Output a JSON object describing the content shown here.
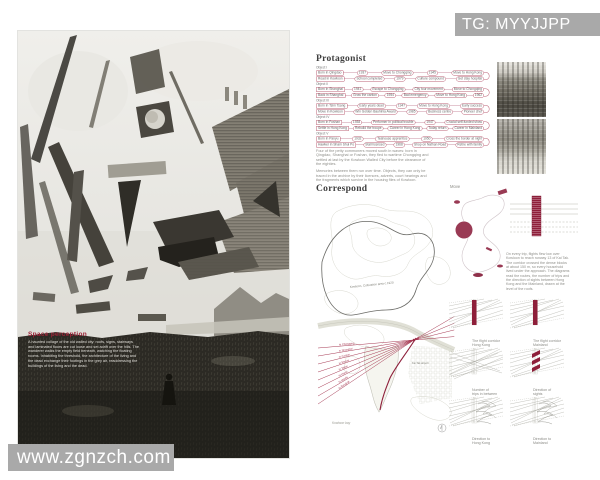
{
  "watermark_top": {
    "text": "TG: MYYJJPP"
  },
  "watermark_bottom": {
    "text": "www.zgnzch.com"
  },
  "poster": {
    "heading": "Space perception",
    "body": "A haunted collage of the old walled city: roofs, signs, stairways and laminated floors are cut loose and set adrift over the hills. The wanderer walks the empty field beneath, watching the floating rooms. Inhabiting the threshold, the architecture of the living and the dead exchange their footings in the grey air, readdressing the buildings of the living and the dead."
  },
  "protagonist": {
    "title": "Protagonist",
    "groups": [
      {
        "label": "Object I",
        "rows": [
          [
            "Born in Qingdao",
            "1937",
            "Move to Chongqing",
            "1945",
            "Move to Hong Kong"
          ],
          [
            "Road in Kowloon",
            "School completed",
            "1979",
            "Culture compound",
            "Get stay hospital"
          ]
        ]
      },
      {
        "label": "Object II",
        "rows": [
          [
            "Born in Shanghai",
            "1941",
            "Escape to Chongqing",
            "City tour movement",
            "Move to Chongqing"
          ],
          [
            "Back in Shanghai",
            "Grow the canton",
            "1954",
            "Bad emergency",
            "Move to Hong Kong",
            "1962"
          ]
        ]
      },
      {
        "label": "Object III",
        "rows": [
          [
            "Born in Tsim Tsang",
            "Early years dead",
            "1947",
            "Move to Hong Kong",
            "Early success"
          ],
          [
            "Move in Kowloon",
            "Win Golden Bauhinia Award",
            "1985",
            "Business centre",
            "Pioneer chef"
          ]
        ]
      },
      {
        "label": "Object IV",
        "rows": [
          [
            "Born in Foshan",
            "1938",
            "Performer in political trouble",
            "1947",
            "Crucial self-funded show"
          ],
          [
            "Settle in Hong Kong",
            "Rebuild the troupe",
            "Career in Hong Kong",
            "Today return",
            "Career in Mainland"
          ]
        ]
      },
      {
        "label": "Object V",
        "rows": [
          [
            "Born in Panyu",
            "1932",
            "Teahouse apprentice",
            "1950",
            "Cross the border at night"
          ],
          [
            "Hawker in Sham Shui Po",
            "Stall licensed",
            "1968",
            "Shop on Nathan Road",
            "Retire with family"
          ]
        ]
      }
    ],
    "notes": [
      "Four of the petty commoners moved south in waves: born in Qingdao, Shanghai or Foshan, they fled to wartime Chongqing and settled at last by the Kowloon Walled City before the clearance of the eighties.",
      "Memories between them run over time. Objects, they can only be traced in the archive by their licences, adverts, court hearings and the fragments which survive in the housing files of Kowloon."
    ]
  },
  "correspond": {
    "title": "Correspond",
    "move_label": "Move",
    "map": {
      "area_label": "Kowloon, Cultivation area c.1920",
      "airport_label": "Kai Tak airport",
      "bay_label": "Kowloon bay"
    },
    "routes": [
      "to Chongqing",
      "to Shanghai",
      "to Canton",
      "to Macau",
      "to Taipei",
      "to Hanoi",
      "to Manila",
      "to Bangkok"
    ],
    "note": "On every trip, flights flew low over Kowloon to reach runway 13 of Kai Tak. The corridor crossed the dense blocks at about 150 m, so every household lived under the approach. The diagrams read the routes, the number of trips and the direction of sights between Hong Kong and the Mainland, drawn at the level of the roofs.",
    "diagrams": [
      {
        "variant": "bar",
        "caption": [
          "The flight corridor",
          "Hong Kong"
        ]
      },
      {
        "variant": "bar",
        "caption": [
          "The flight corridor",
          "Mainland"
        ]
      },
      {
        "variant": "lines",
        "caption": [
          "Number of",
          "trips in between"
        ]
      },
      {
        "variant": "chevrons",
        "caption": [
          "Direction of",
          "sights"
        ]
      },
      {
        "variant": "scribble",
        "caption": [
          "Direction to",
          "Hong Kong"
        ]
      },
      {
        "variant": "scribble",
        "caption": [
          "Direction to",
          "Mainland"
        ]
      }
    ]
  }
}
